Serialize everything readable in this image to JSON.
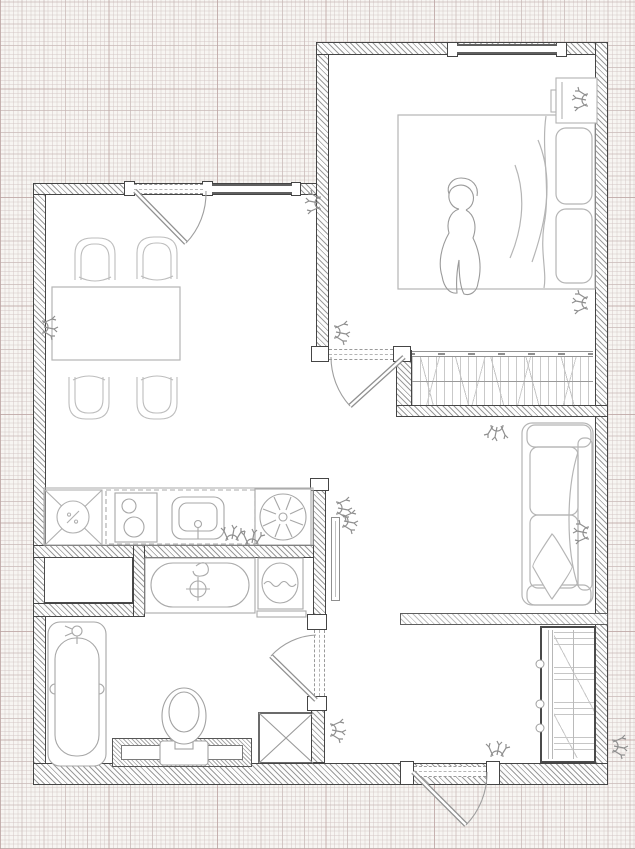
{
  "meta": {
    "kind": "architectural-floor-plan",
    "description": "One-bedroom apartment plan, technical line drawing on graph paper",
    "visible_text": "none"
  },
  "palette": {
    "paper": "#f7f5f2",
    "room-fill": "#ffffff",
    "wall-edge": "#454545",
    "wall-hatch": "#9b9b9b",
    "furniture-line": "#b5b5b5",
    "fixture-line": "#9e9e9e",
    "door-line": "#8f8f8f",
    "dash-line": "#9a9a9a"
  },
  "rooms": [
    {
      "id": "living-dining-kitchen",
      "fixtures": [
        "entry-door",
        "interior-window",
        "dining-table",
        "chair",
        "chair",
        "chair",
        "chair",
        "kitchen-counter",
        "refrigerator",
        "upper-cabinets-dashed",
        "cooktop",
        "kitchen-sink",
        "washing-machine"
      ]
    },
    {
      "id": "bedroom",
      "fixtures": [
        "window",
        "double-bed",
        "pillow",
        "pillow",
        "blanket",
        "person-figure",
        "nightstand",
        "built-in-wardrobe",
        "bedroom-door"
      ]
    },
    {
      "id": "lounge",
      "fixtures": [
        "sofa",
        "seat-cushion",
        "seat-cushion",
        "diamond-pillow",
        "bolster"
      ]
    },
    {
      "id": "bathroom",
      "fixtures": [
        "bathroom-door",
        "bathtub-large",
        "toilet",
        "toilet-partition",
        "service-shaft",
        "vanity-tub",
        "water-heater",
        "wall-niche",
        "shelf"
      ]
    },
    {
      "id": "hallway",
      "fixtures": [
        "entrance-door",
        "shoe-closet",
        "wall-mirror"
      ]
    }
  ],
  "symbols": {
    "socket-switch-glyph-count": 14,
    "door-count": 4,
    "window-count": 2
  }
}
